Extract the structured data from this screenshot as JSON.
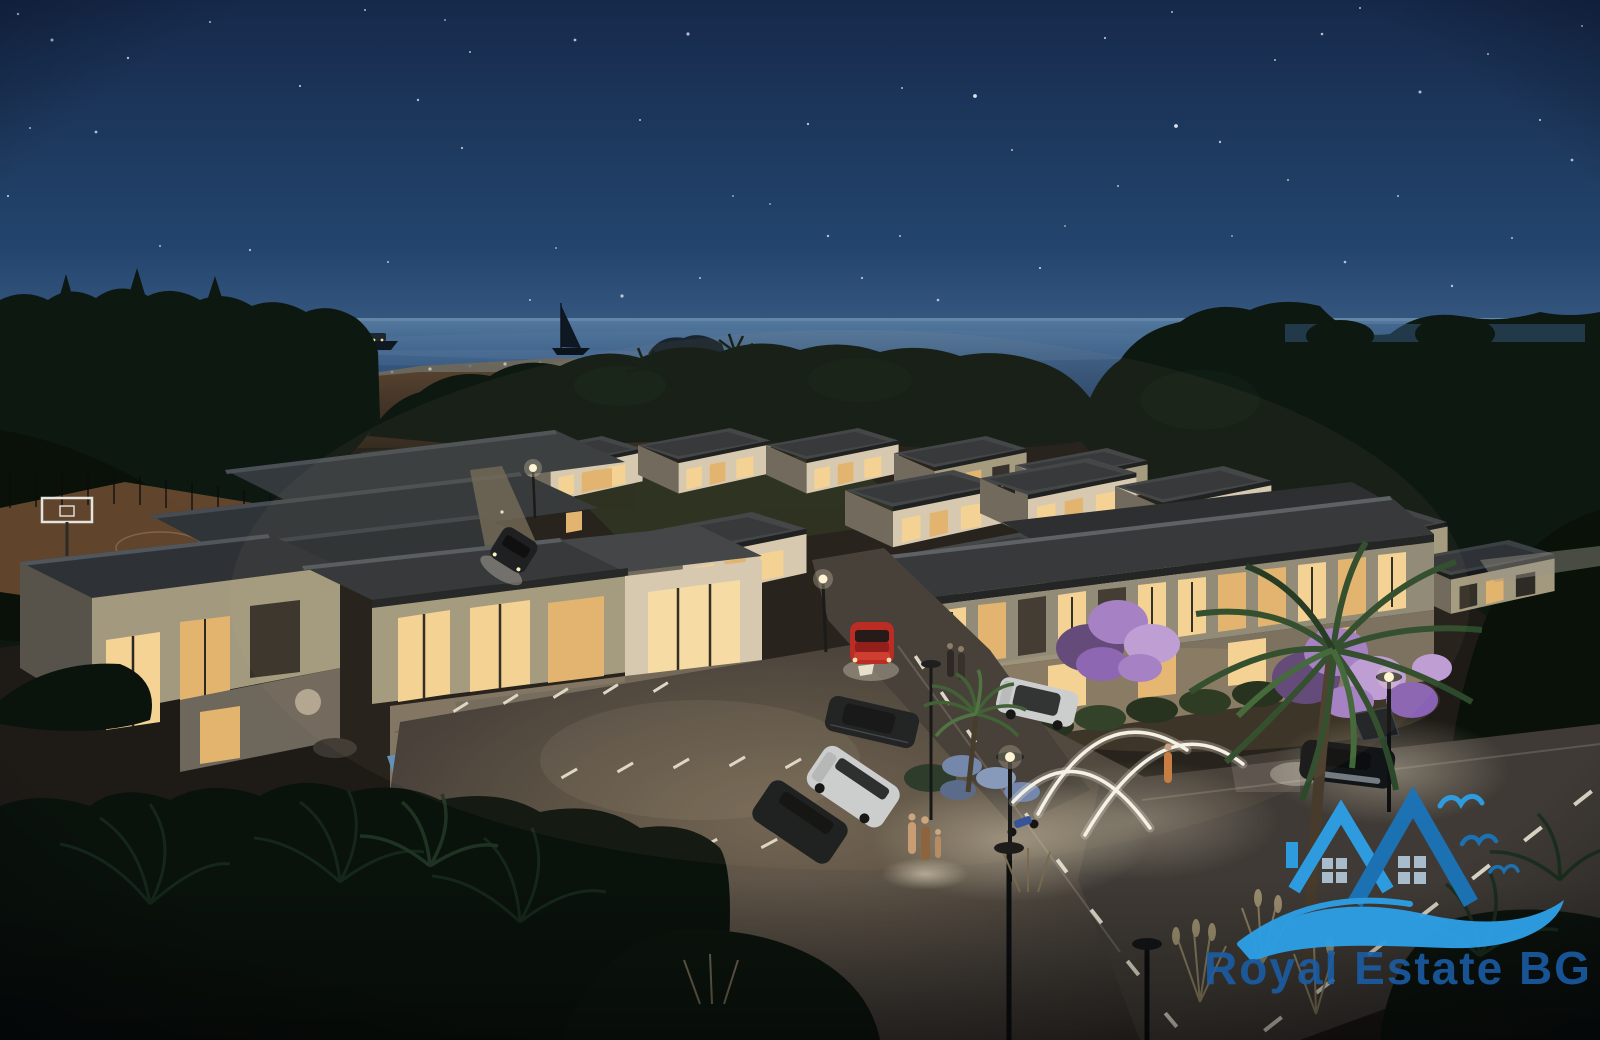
{
  "watermark": {
    "brand": "Royal Estate BG",
    "colors": {
      "light_blue": "#2E9FE6",
      "dark_blue": "#1B74B8",
      "text_blue": "#1B5EA6",
      "window_grey": "#AEC2D2"
    }
  },
  "palette": {
    "sky_top": "#16294b",
    "sky_mid": "#23456d",
    "sky_horizon": "#4a6a92",
    "sea_top": "#567b9f",
    "sea": "#365a82",
    "sea_deep": "#27436a",
    "sand": "#6e675b",
    "dune_light": "#55412f",
    "dune_dark": "#2d241b",
    "forest": "#0d1811",
    "forest_deep": "#091108",
    "forest_soft": "#142419",
    "ground": "#1e1b17",
    "grass": "#2a3520",
    "roof_top": "#3b4044",
    "roof_dark": "#2e3236",
    "wall_lit": "#d6cab2",
    "wall_dim": "#a2997f",
    "wall_shade": "#6c675b",
    "window_warm": "#f4d395",
    "window_warm2": "#e2b46e",
    "asphalt": "#3f3a35",
    "lot_light": "#6e6150",
    "road_line": "#ded8c8",
    "pool": "#5d8fb8",
    "arch_glow": "#f7f4ea",
    "bloom": "#a37fc9",
    "bloom_light": "#bd9cd9",
    "car_red": "#b92420",
    "car_white": "#cbced1",
    "glow_warm": "#f7e2b0"
  },
  "scene": {
    "setting": "aerial night view of seaside villa complex",
    "sea_objects": [
      "yacht",
      "sailboat",
      "rocky-islet",
      "beach-with-umbrellas"
    ],
    "amenities": [
      "basketball-court",
      "swimming-pool",
      "entrance-arches",
      "street-lamps",
      "palm-trees",
      "purple-bloom-trees"
    ],
    "vehicles": [
      "red-sports-car",
      "white-sedan",
      "dark-coupe",
      "white-minivan",
      "dark-suv",
      "motorcycle",
      "dark-sports-car",
      "courtyard-car"
    ],
    "people": [
      "couple-by-building",
      "family-in-parking",
      "woman-at-arches"
    ]
  },
  "stars": [
    [
      18,
      14,
      1.2
    ],
    [
      52,
      40,
      1.5
    ],
    [
      128,
      58,
      1.2
    ],
    [
      210,
      22,
      1
    ],
    [
      300,
      86,
      1.1
    ],
    [
      365,
      10,
      1
    ],
    [
      418,
      100,
      1.2
    ],
    [
      470,
      52,
      1
    ],
    [
      575,
      40,
      1.4
    ],
    [
      640,
      120,
      1
    ],
    [
      688,
      34,
      1.6
    ],
    [
      733,
      196,
      0.9
    ],
    [
      808,
      124,
      1.2
    ],
    [
      862,
      278,
      1.1
    ],
    [
      902,
      88,
      1
    ],
    [
      938,
      300,
      1.3
    ],
    [
      1012,
      150,
      1
    ],
    [
      1065,
      226,
      0.9
    ],
    [
      1105,
      38,
      1.1
    ],
    [
      1172,
      12,
      1
    ],
    [
      1220,
      142,
      1.2
    ],
    [
      1275,
      60,
      1
    ],
    [
      1322,
      34,
      1.3
    ],
    [
      1360,
      8,
      1
    ],
    [
      1420,
      92,
      1.5
    ],
    [
      1488,
      54,
      1
    ],
    [
      1540,
      120,
      1.1
    ],
    [
      1582,
      26,
      1
    ],
    [
      30,
      128,
      1
    ],
    [
      8,
      196,
      1.1
    ],
    [
      96,
      132,
      1.4
    ],
    [
      160,
      246,
      1
    ],
    [
      250,
      250,
      1.1
    ],
    [
      318,
      310,
      0.9
    ],
    [
      388,
      262,
      1
    ],
    [
      462,
      148,
      1.1
    ],
    [
      530,
      300,
      1
    ],
    [
      556,
      248,
      0.9
    ],
    [
      622,
      296,
      1.6
    ],
    [
      700,
      278,
      1
    ],
    [
      770,
      204,
      0.9
    ],
    [
      828,
      236,
      1.2
    ],
    [
      900,
      236,
      1
    ],
    [
      975,
      96,
      1.9
    ],
    [
      1040,
      268,
      1.1
    ],
    [
      1118,
      186,
      1
    ],
    [
      1176,
      126,
      1.9
    ],
    [
      1232,
      236,
      0.9
    ],
    [
      1288,
      180,
      1
    ],
    [
      1345,
      262,
      1.3
    ],
    [
      1398,
      196,
      1
    ],
    [
      1452,
      286,
      1.2
    ],
    [
      1512,
      238,
      1
    ],
    [
      1572,
      160,
      1.4
    ],
    [
      171,
      318,
      1.1
    ],
    [
      445,
      20,
      0.9
    ]
  ]
}
